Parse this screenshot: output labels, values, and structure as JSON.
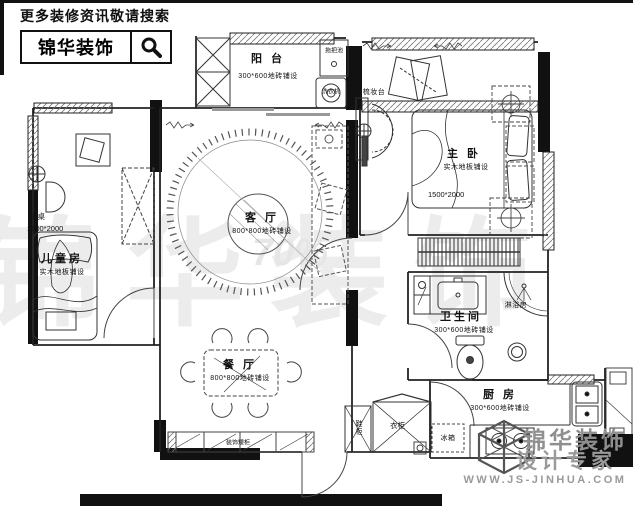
{
  "header": {
    "tagline": "更多装修资讯敬请搜索",
    "brand": "锦华装饰"
  },
  "rooms": {
    "balcony": {
      "name": "阳 台",
      "floor": "300*600地砖铺设"
    },
    "living": {
      "name": "客 厅",
      "floor": "800*800地砖铺设"
    },
    "dining": {
      "name": "餐 厅",
      "floor": "800*800地砖铺设"
    },
    "master": {
      "name": "主 卧",
      "floor": "实木地板铺设",
      "bed_size": "1500*2000"
    },
    "kids": {
      "name": "儿童房",
      "floor": "实木地板铺设",
      "bed_size": "1200*2000",
      "desk": "书桌"
    },
    "bathroom": {
      "name": "卫生间",
      "floor": "300*600地砖铺设",
      "shower": "淋浴房"
    },
    "kitchen": {
      "name": "厨 房",
      "floor": "300*600地砖铺设",
      "fridge": "冰箱"
    }
  },
  "fixtures": {
    "washer": "洗衣机",
    "mop_pool": "拖把池",
    "dresser": "梳妆台",
    "shoe_cabinet": "鞋柜",
    "wardrobe": "衣柜",
    "low_cabinet": "装饰矮柜"
  },
  "watermark": {
    "center": "锦华装饰",
    "fragment": "70%",
    "brand": "锦华装饰",
    "slogan": "设计专家",
    "url": "WWW.JS-JINHUA.COM"
  },
  "colors": {
    "wall": "#111111",
    "line": "#333333",
    "dashed": "#555555",
    "watermark_gray": "#ececec"
  }
}
